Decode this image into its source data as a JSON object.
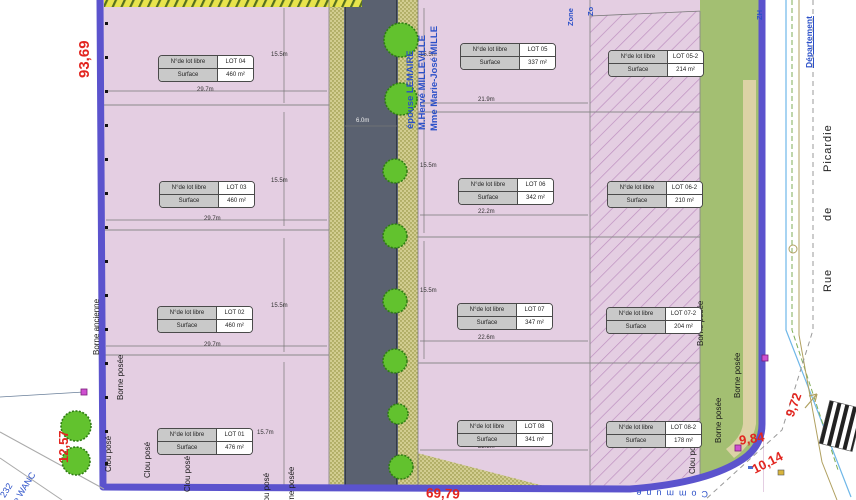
{
  "table_headers": {
    "lot": "N°de lot libre",
    "surface": "Surface"
  },
  "lots": [
    {
      "id": "LOT 01",
      "surface": "476 m²"
    },
    {
      "id": "LOT 02",
      "surface": "460 m²"
    },
    {
      "id": "LOT 03",
      "surface": "460 m²"
    },
    {
      "id": "LOT 04",
      "surface": "460 m²"
    },
    {
      "id": "LOT 05",
      "surface": "337 m²"
    },
    {
      "id": "LOT 06",
      "surface": "342 m²"
    },
    {
      "id": "LOT 07",
      "surface": "347 m²"
    },
    {
      "id": "LOT 08",
      "surface": "341 m²"
    },
    {
      "id": "LOT 05-2",
      "surface": "214 m²"
    },
    {
      "id": "LOT 06-2",
      "surface": "210 m²"
    },
    {
      "id": "LOT 07-2",
      "surface": "204 m²"
    },
    {
      "id": "LOT 08-2",
      "surface": "178 m²"
    }
  ],
  "dimensions": [
    "29.7m",
    "29.7m",
    "29.7m",
    "15.5m",
    "15.5m",
    "15.5m",
    "15.7m",
    "21.9m",
    "22.2m",
    "22.6m",
    "22.8m",
    "15.5m",
    "15.5m",
    "15.5m",
    "6.0m"
  ],
  "red_measures": {
    "left_top": "93,69",
    "left_bottom": "12,57",
    "bottom": "69,79",
    "corner_1": "9,84",
    "corner_2": "10,14",
    "corner_3": "9,72"
  },
  "owners": {
    "line1": "épouse LEMAIRE",
    "line2": "M.Hervé MILLEVILLE",
    "line3": "Mme Marie-José MILLE"
  },
  "zones": {
    "zone": "Zone",
    "zone_cut": "Zo",
    "zh": "ZH",
    "departement": "Département",
    "commune": "Commune",
    "chemin_num": "232",
    "chemin_name": "de WANC"
  },
  "survey_labels": {
    "borne_ancienne": "Borne ancienne",
    "borne_posee": "Borne posée",
    "clou_pose": "Clou posé"
  },
  "street": {
    "w1": "Rue",
    "w2": "de",
    "w3": "Picardie"
  },
  "colors": {
    "boundary_blue": "#5b53cd",
    "lot_pink": "#e4cee2",
    "road_gray": "#5a6170",
    "green_strip": "#a3bf72",
    "measure_red": "#e2251f",
    "annotation_blue": "#2b50c8"
  }
}
